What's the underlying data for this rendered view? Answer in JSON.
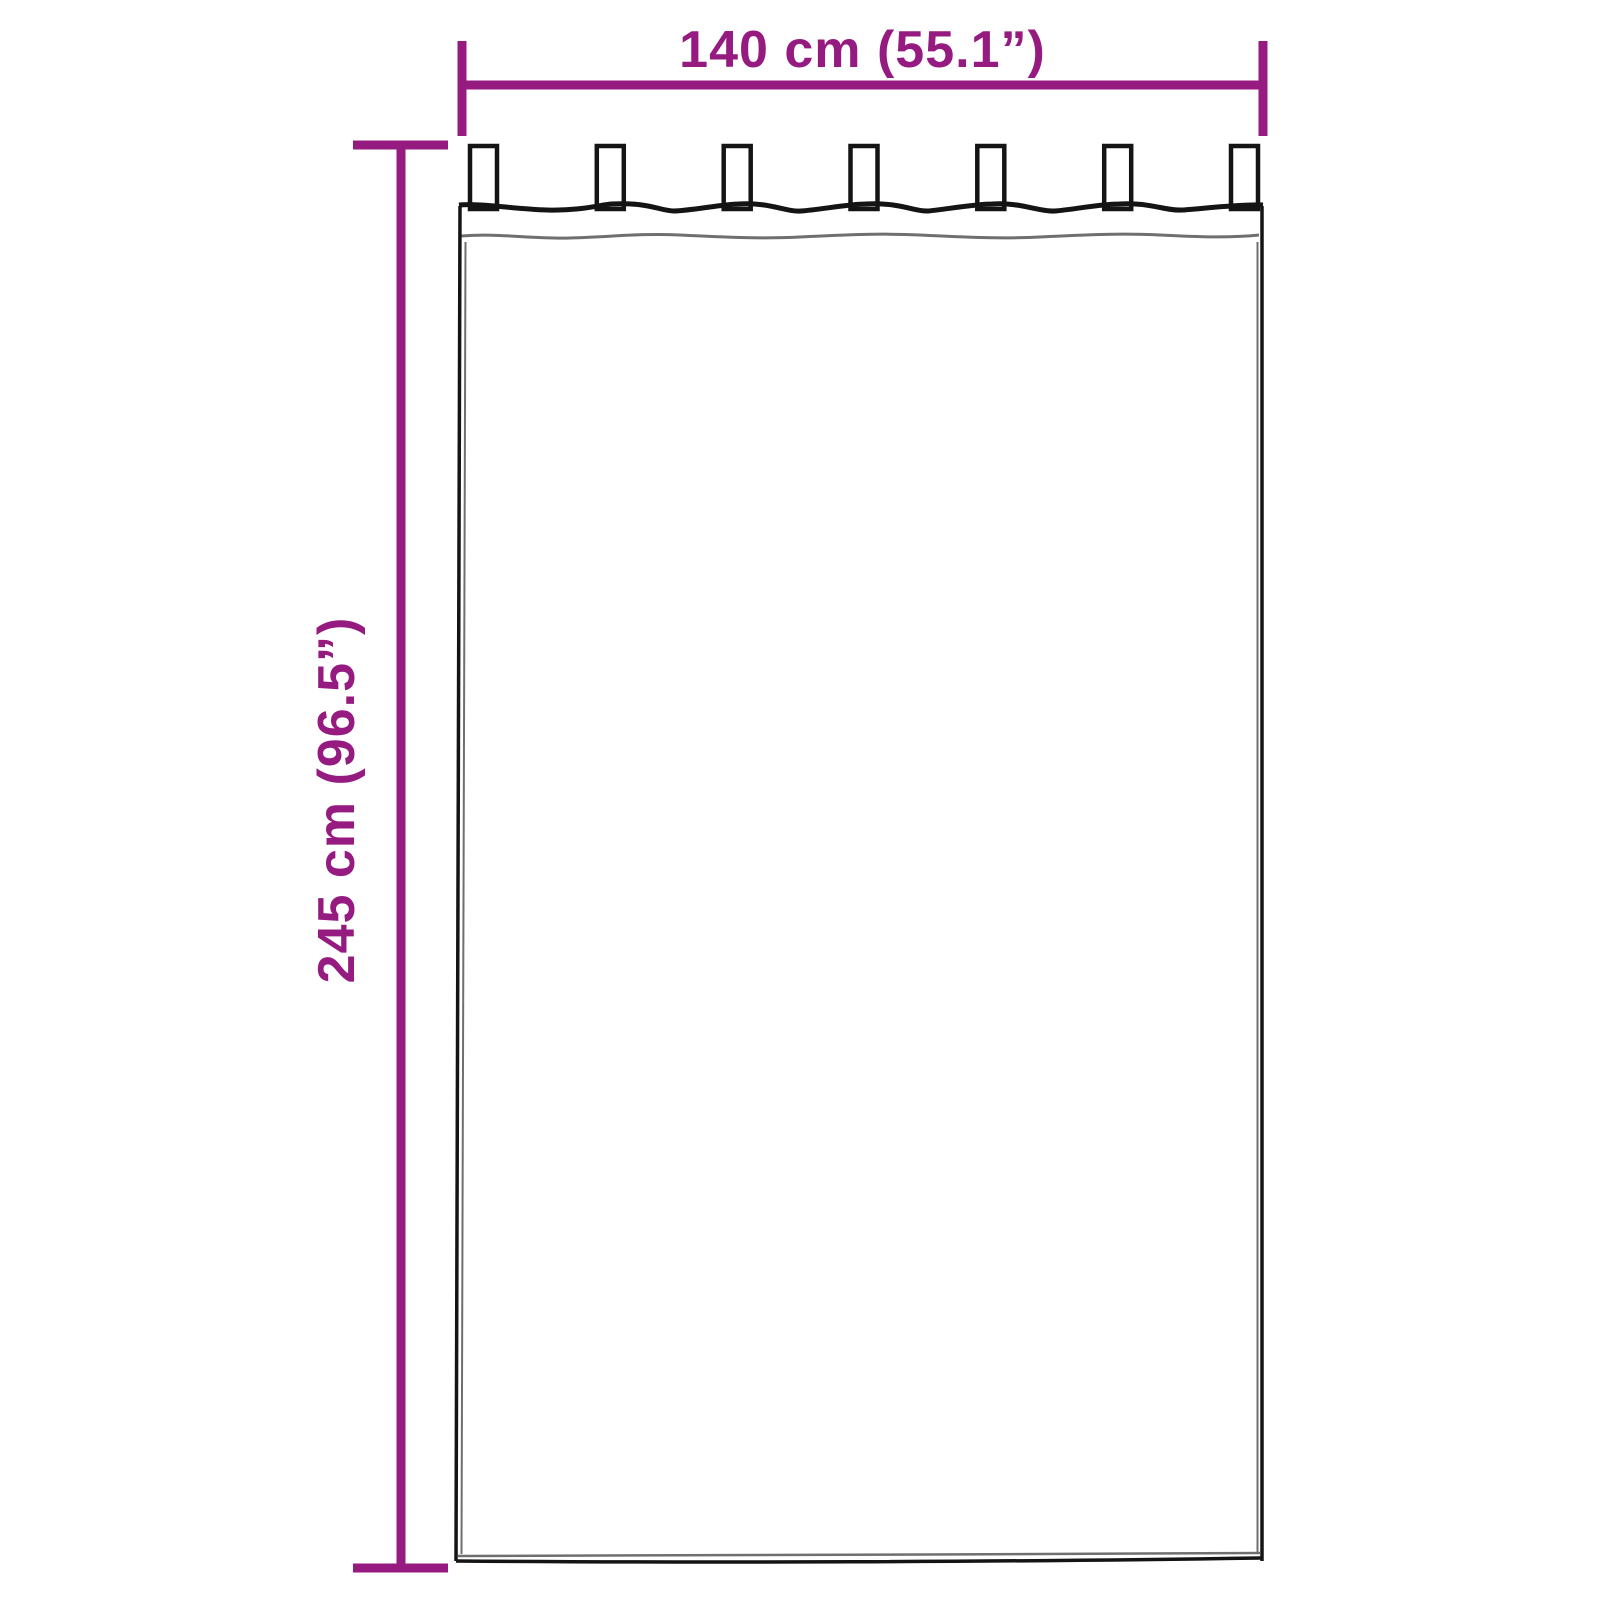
{
  "colors": {
    "accent": "#951B81",
    "outline_dark": "#141414",
    "outline_gray": "#6F6F6F",
    "background": "#FFFFFF"
  },
  "diagram": {
    "width_dimension": {
      "label": "140 cm (55.1”)",
      "cm": 140,
      "inches": 55.1
    },
    "height_dimension": {
      "label": "245 cm (96.5”)",
      "cm": 245,
      "inches": 96.5
    },
    "curtain": {
      "tab_count": 7
    }
  }
}
